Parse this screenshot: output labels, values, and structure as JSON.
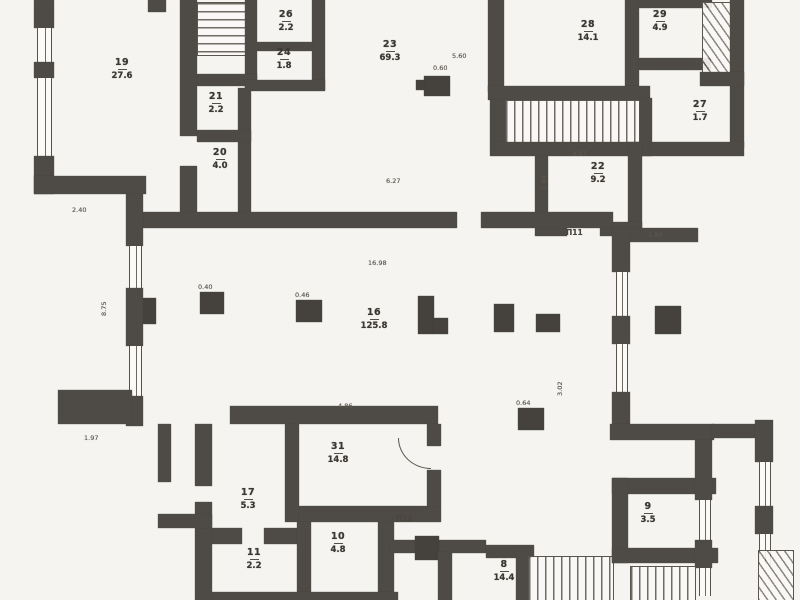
{
  "document": {
    "type": "scanned floor plan",
    "floor_area_room_count": 17
  },
  "rooms": [
    {
      "number": "19",
      "area": "27.6"
    },
    {
      "number": "26",
      "area": "2.2"
    },
    {
      "number": "24",
      "area": "1.8"
    },
    {
      "number": "21",
      "area": "2.2"
    },
    {
      "number": "20",
      "area": "4.0"
    },
    {
      "number": "23",
      "area": "69.3"
    },
    {
      "number": "28",
      "area": "14.1"
    },
    {
      "number": "29",
      "area": "4.9"
    },
    {
      "number": "27",
      "area": "1.7"
    },
    {
      "number": "22",
      "area": "9.2"
    },
    {
      "number": "16",
      "area": "125.8"
    },
    {
      "number": "31",
      "area": "14.8"
    },
    {
      "number": "17",
      "area": "5.3"
    },
    {
      "number": "11",
      "area": "2.2"
    },
    {
      "number": "10",
      "area": "4.8"
    },
    {
      "number": "9",
      "area": "3.5"
    },
    {
      "number": "8",
      "area": "14.4"
    }
  ],
  "annotations": {
    "stair_upper": "П11",
    "stair_lower": "П12"
  },
  "dimensions": [
    "2.40",
    "8.75",
    "0.60",
    "5.60",
    "6.27",
    "16.98",
    "3.97",
    "1.04",
    "1.84",
    "0.40",
    "0.46",
    "0.64",
    "3.02",
    "1.97",
    "4.86"
  ],
  "colors": {
    "wall": "#4e4a45",
    "paper": "#f5f4f1",
    "ink": "#3b3732",
    "faint": "#8a857e"
  }
}
